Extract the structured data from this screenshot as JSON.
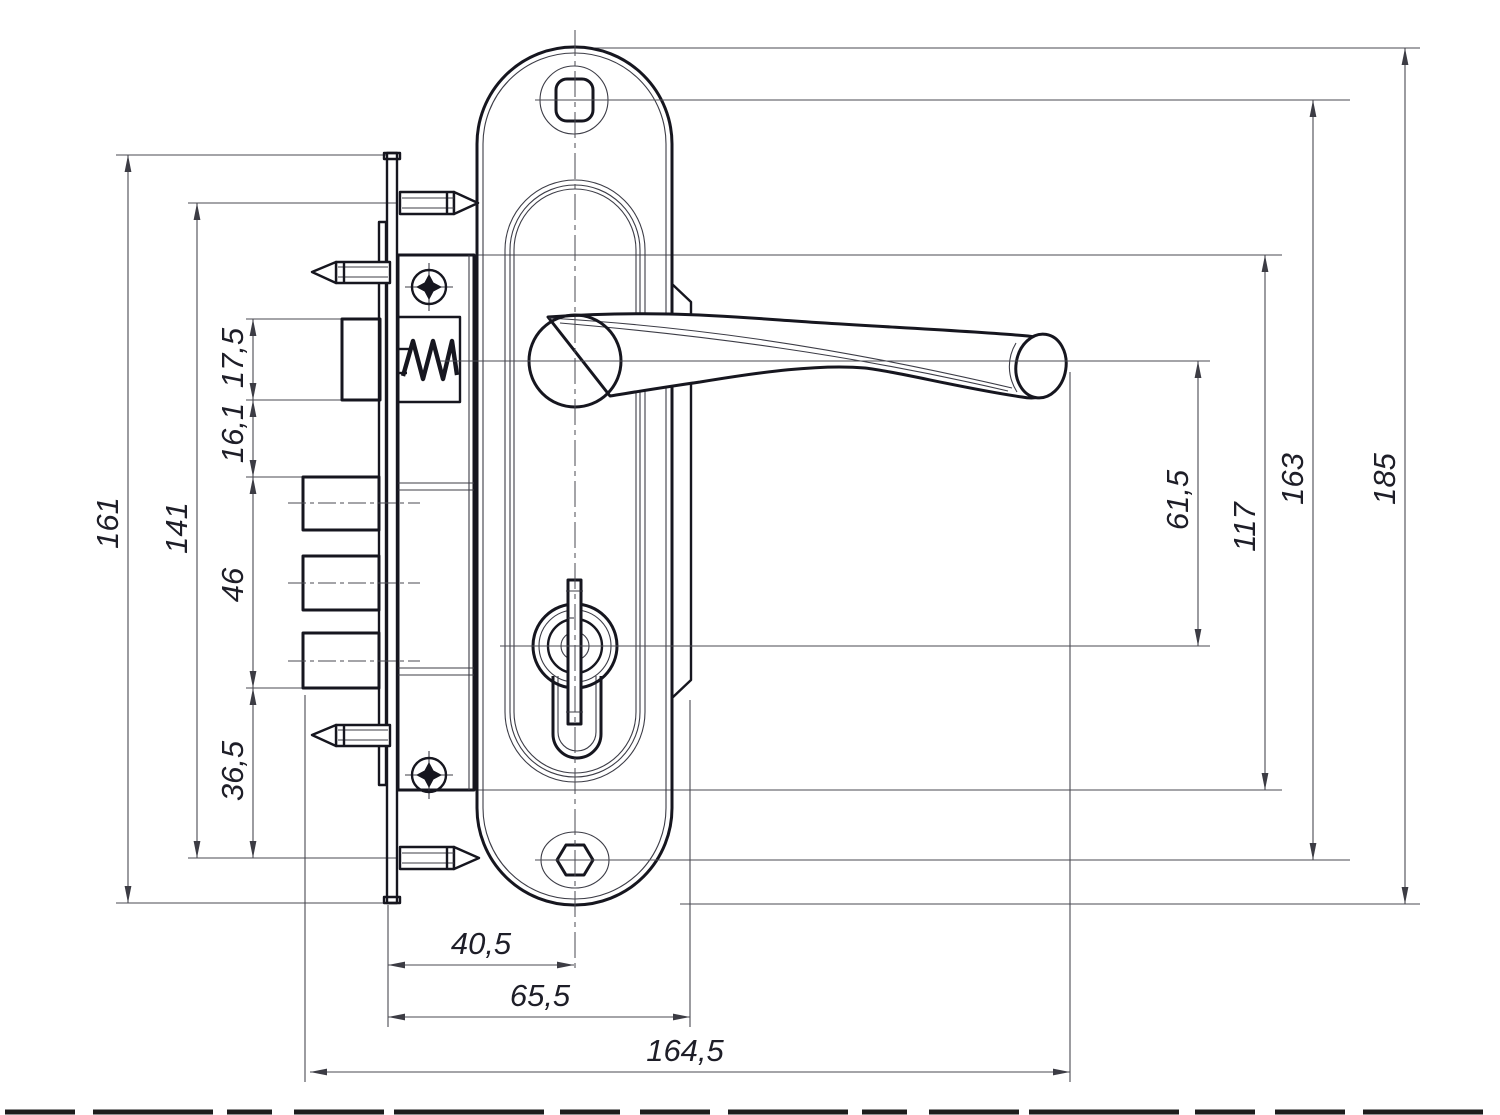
{
  "drawing": {
    "background": "#ffffff",
    "object_line_color": "#16161f",
    "dimension_line_color": "#4a4a52",
    "label_color": "#1e1e28"
  },
  "dims": {
    "faceplate_height": "161",
    "spike_spacing": "141",
    "latch_height": "17,5",
    "latch_to_bolts_gap": "16,1",
    "bolt_block_height": "46",
    "bolts_to_spike": "36,5",
    "handle_to_cylinder": "61,5",
    "lock_case_height": "117",
    "screw_hole_spacing": "163",
    "plate_height": "185",
    "backset": "40,5",
    "case_to_plate_depth": "65,5",
    "overall_width": "164,5"
  }
}
